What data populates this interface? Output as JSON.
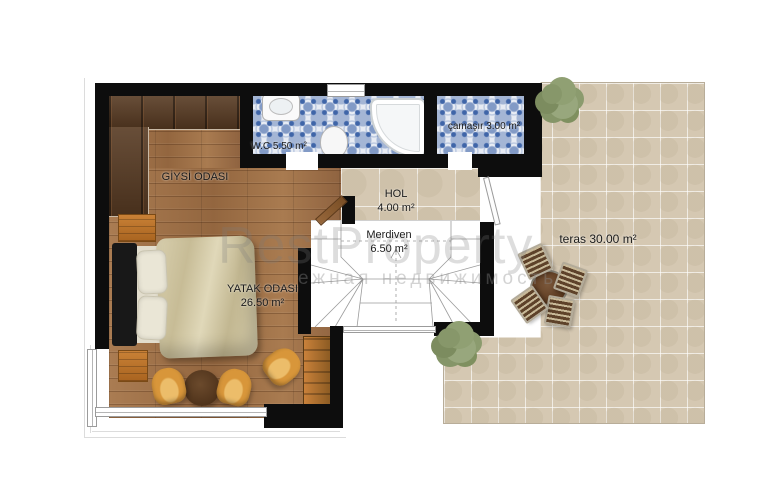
{
  "rooms": {
    "giysi": {
      "name": "GİYSİ ODASI"
    },
    "wc": {
      "name": "W.C 5.50 m²"
    },
    "camasir": {
      "name": "çamaşır 3.00 m²"
    },
    "hol": {
      "name": "HOL",
      "area": "4.00 m²"
    },
    "merdiven": {
      "name": "Merdiven",
      "area": "6.50 m²"
    },
    "yatak": {
      "name": "YATAK ODASI",
      "area": "26.50 m²"
    },
    "teras": {
      "name": "teras 30.00 m²"
    }
  },
  "watermark": {
    "line1": "RestProperty",
    "line2": "ежная недвижимость"
  },
  "colors": {
    "wall": "#0d0d0d",
    "wood_floor": "#a0714a",
    "dark_wood": "#573a22",
    "tile_blue": "#3f65a8",
    "tile_beige": "#d5c8b2",
    "chair_yellow": "#d8963a",
    "bush_green": "#87976a"
  }
}
